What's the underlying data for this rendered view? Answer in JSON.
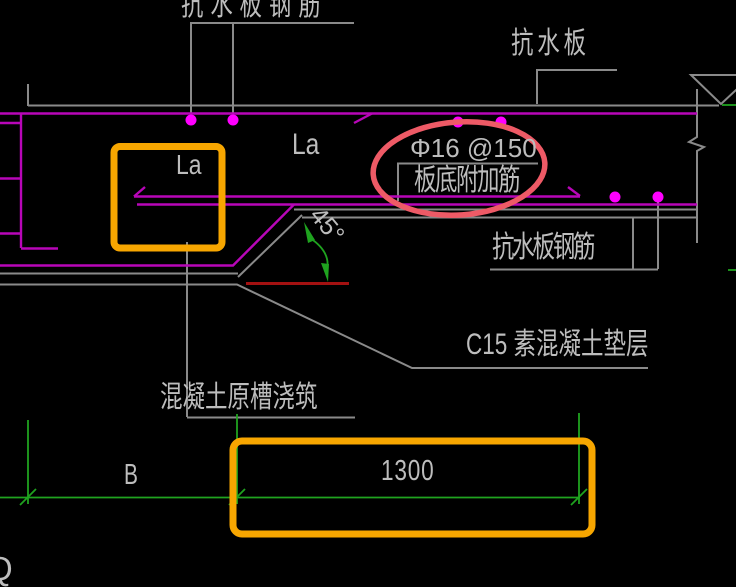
{
  "drawing": {
    "labels": {
      "top_rebar": "抗水板钢筋",
      "slab": "抗水板",
      "rebar_spec": "Φ16 @150",
      "rebar_spec_name": "板底附加筋",
      "anchorage_left": "La",
      "anchorage_right": "La",
      "angle": "45°",
      "right_rebar": "抗水板钢筋",
      "cushion": "C15 素混凝土垫层",
      "trench": "混凝土原槽浇筑",
      "corner_letter": "Q"
    },
    "dimensions": {
      "span_label": "B",
      "length_value": "1300"
    },
    "colors": {
      "background": "#000000",
      "line_gray": "#8a8a8a",
      "rebar_magenta": "#b806b8",
      "dot_magenta": "#ff00ff",
      "dimension_green": "#1fa31f",
      "cut_red": "#a31111",
      "highlight_orange": "#f7a600",
      "highlight_ellipse": "#ee5a66",
      "text_gray": "#bdbdbd"
    }
  }
}
